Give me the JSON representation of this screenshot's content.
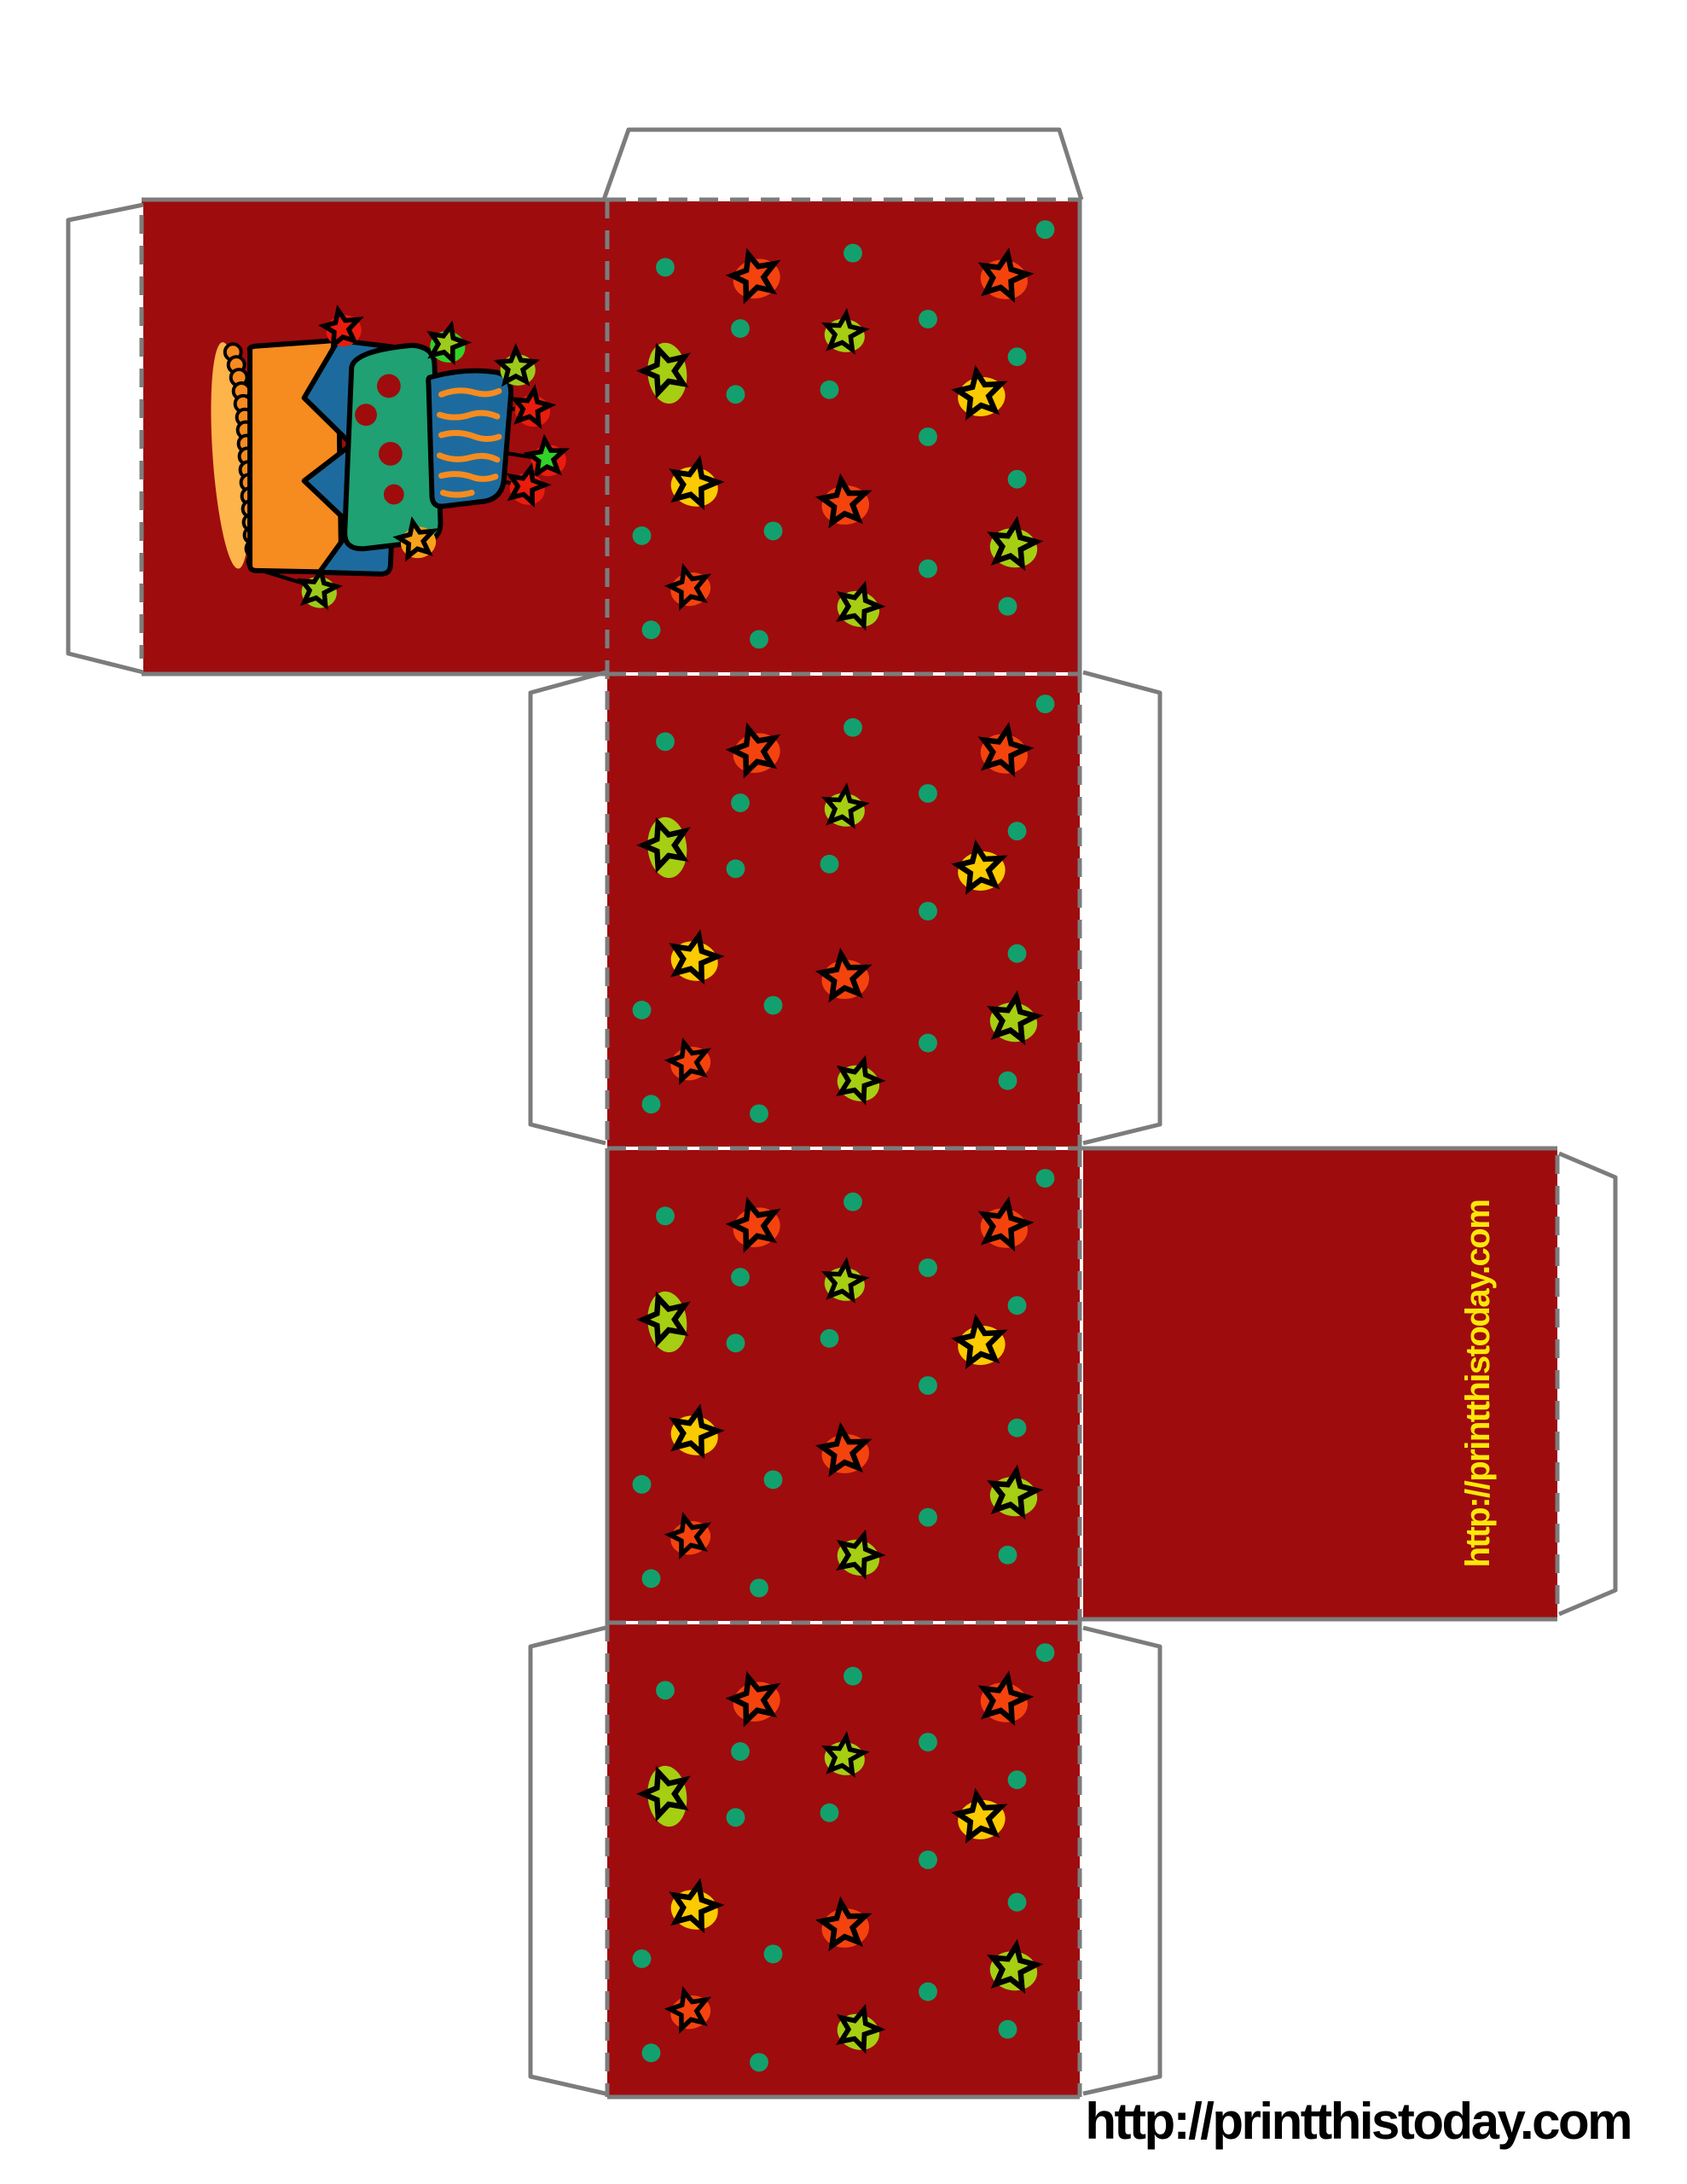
{
  "document": {
    "type_label": "printable-gift-box-template",
    "footer_url": "http://printthistoday.com",
    "side_panel_url": "http://printthistoday.com"
  },
  "colors": {
    "panel_red": "#9E0C0E",
    "line_gray": "#7C7C7C",
    "dot_teal": "#12A16E",
    "star_red": "#F5430E",
    "star_lime": "#A6CE13",
    "star_yellow": "#FBCA00",
    "text_yellow": "#FFE70A",
    "text_black": "#000000",
    "cake_orange": "#F68B1F",
    "cake_blue": "#1D6B9E",
    "cake_green": "#1FA173",
    "cake_dot_red": "#9E0C0E",
    "bead_glow": "#FDB44B",
    "cake_star_red": "#EA1C0D",
    "cake_star_lime": "#9CCB1D",
    "cake_star_green": "#33D229",
    "cake_star_orange": "#F7A11C",
    "flap_white": "#FFFFFF"
  },
  "pattern": {
    "stars": [
      {
        "color": "red",
        "x": 0.31,
        "y": 0.16,
        "rot": -15
      },
      {
        "color": "red",
        "x": 0.84,
        "y": 0.16,
        "rot": 12
      },
      {
        "color": "lime",
        "x": 0.12,
        "y": 0.36,
        "rot": -18,
        "tall": true
      },
      {
        "color": "lime",
        "x": 0.5,
        "y": 0.28,
        "rot": 8,
        "scale": 0.85
      },
      {
        "color": "yellow",
        "x": 0.79,
        "y": 0.41,
        "rot": -8
      },
      {
        "color": "yellow",
        "x": 0.18,
        "y": 0.6,
        "rot": 14
      },
      {
        "color": "red",
        "x": 0.5,
        "y": 0.64,
        "rot": -6
      },
      {
        "color": "lime",
        "x": 0.86,
        "y": 0.73,
        "rot": 10
      },
      {
        "color": "red",
        "x": 0.17,
        "y": 0.82,
        "rot": -14,
        "scale": 0.85
      },
      {
        "color": "lime",
        "x": 0.53,
        "y": 0.86,
        "rot": 18,
        "scale": 0.9
      }
    ],
    "dots": [
      [
        0.12,
        0.14
      ],
      [
        0.52,
        0.11
      ],
      [
        0.93,
        0.06
      ],
      [
        0.28,
        0.27
      ],
      [
        0.68,
        0.25
      ],
      [
        0.87,
        0.33
      ],
      [
        0.27,
        0.41
      ],
      [
        0.47,
        0.4
      ],
      [
        0.68,
        0.5
      ],
      [
        0.87,
        0.59
      ],
      [
        0.07,
        0.71
      ],
      [
        0.35,
        0.7
      ],
      [
        0.68,
        0.78
      ],
      [
        0.09,
        0.91
      ],
      [
        0.32,
        0.93
      ],
      [
        0.85,
        0.86
      ]
    ]
  }
}
